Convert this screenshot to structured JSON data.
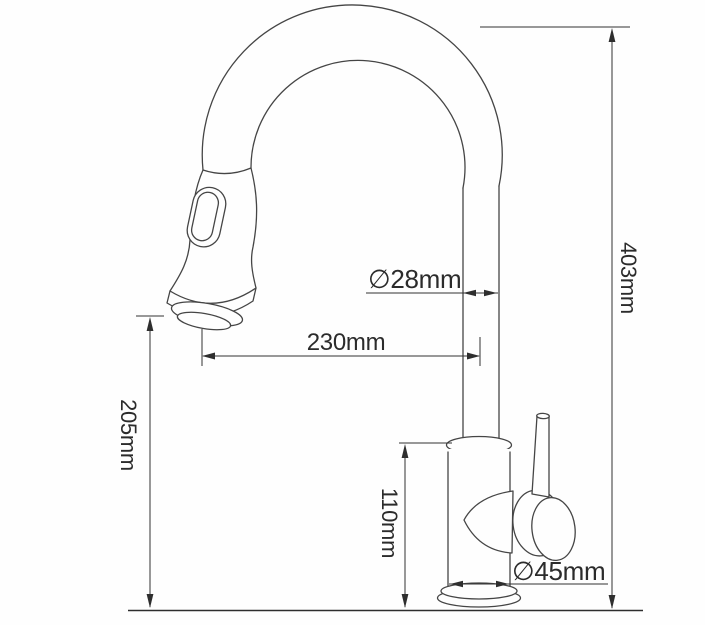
{
  "diagram": {
    "subject": "pull-out kitchen faucet dimension drawing",
    "colors": {
      "background": "#fefefe",
      "drawing_line": "#454545",
      "dimension_line": "#333333",
      "text": "#2b2b2b"
    },
    "dimensions": {
      "spout_tube_diameter": "∅28mm",
      "spout_reach": "230mm",
      "outlet_clearance_height": "205mm",
      "overall_height": "403mm",
      "body_height": "110mm",
      "body_diameter": "∅45mm"
    }
  }
}
